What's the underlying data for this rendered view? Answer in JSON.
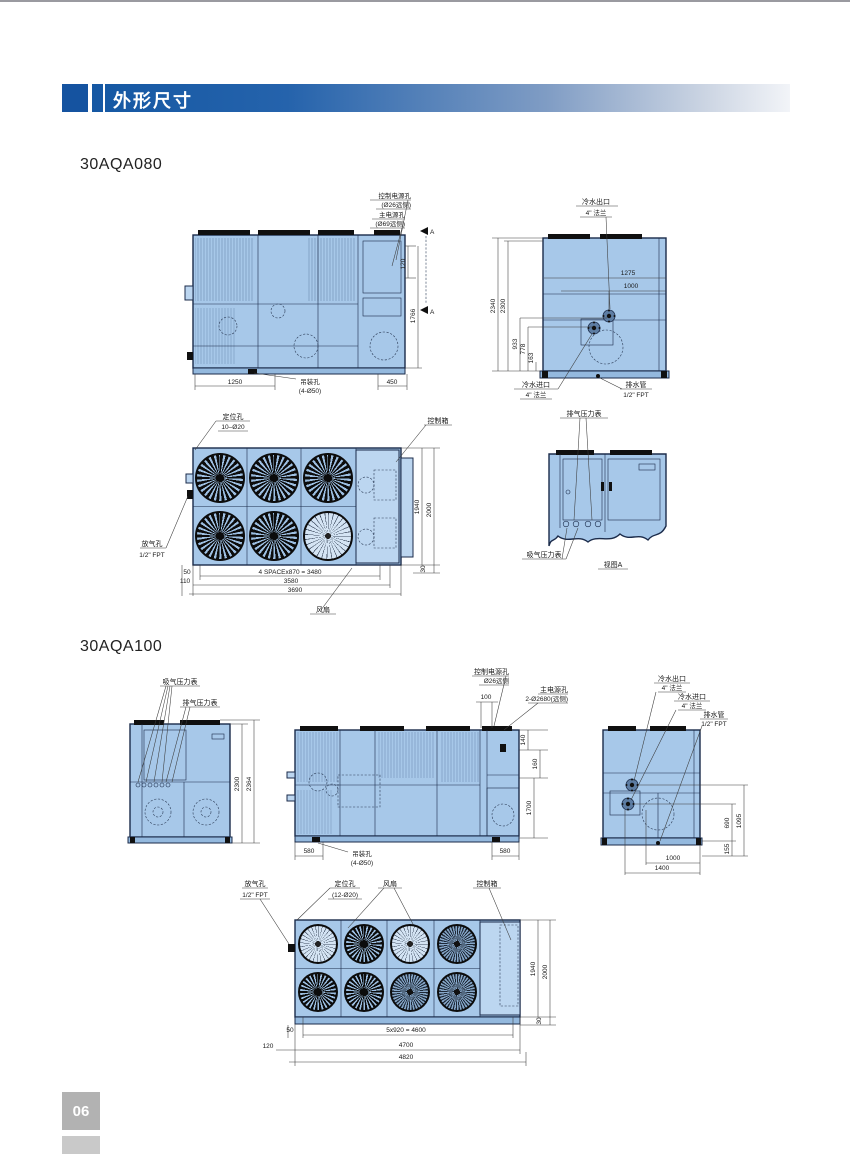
{
  "page": {
    "header_title": "外形尺寸",
    "page_number": "06",
    "model_080": "30AQA080",
    "model_100": "30AQA100"
  },
  "aqa080": {
    "front": {
      "control_power": "控制电源孔",
      "control_power_d": "(Ø26远侧)",
      "main_power": "主电源孔",
      "main_power_d": "(Ø69远侧)",
      "section_a_top": "A",
      "section_a_bottom": "A",
      "d120": "120",
      "d1766": "1766",
      "d1250": "1250",
      "lifting": "吊装孔",
      "lifting_d": "(4-Ø50)",
      "d450": "450"
    },
    "side": {
      "outlet": "冷水出口",
      "outlet_d": "4\" 法兰",
      "d1275": "1275",
      "d1000": "1000",
      "d2340": "2340",
      "d2300": "2300",
      "d933": "933",
      "d778": "778",
      "d163": "163",
      "inlet": "冷水进口",
      "inlet_d": "4\" 法兰",
      "drain": "排水管",
      "drain_d": "1/2\" FPT"
    },
    "top": {
      "locating": "定位孔",
      "locating_d": "10–Ø20",
      "control_box": "控制箱",
      "vent": "放气孔",
      "vent_d": "1/2\" FPT",
      "d50": "50",
      "d110": "110",
      "space": "4 SPACEx870 = 3480",
      "d3580": "3580",
      "d3690": "3690",
      "d1940": "1940",
      "d2000": "2000",
      "d30": "30",
      "fan": "风扇"
    },
    "detail": {
      "discharge": "排气压力表",
      "suction": "吸气压力表",
      "view_a": "视图A"
    }
  },
  "aqa100": {
    "left": {
      "suction": "吸气压力表",
      "discharge": "排气压力表",
      "d2300": "2300",
      "d2364": "2364"
    },
    "front": {
      "control_power": "控制电源孔",
      "control_power_d": "Ø26远侧",
      "d100": "100",
      "main_power": "主电源孔",
      "main_power_d": "2-Ø2680(远侧)",
      "d140": "140",
      "d160": "160",
      "d1700": "1700",
      "d580_left": "580",
      "lifting": "吊装孔",
      "lifting_d": "(4-Ø50)",
      "d580_right": "580"
    },
    "right": {
      "outlet": "冷水出口",
      "outlet_d": "4\" 法兰",
      "inlet": "冷水进口",
      "inlet_d": "4\" 法兰",
      "drain": "排水管",
      "drain_d": "1/2\" FPT",
      "d1095": "1095",
      "d690": "690",
      "d155": "155",
      "d1000": "1000",
      "d1400": "1400"
    },
    "top": {
      "vent": "放气孔",
      "vent_d": "1/2\" FPT",
      "locating": "定位孔",
      "locating_d": "(12-Ø20)",
      "fan": "风扇",
      "control_box": "控制箱",
      "d1940": "1940",
      "d2000": "2000",
      "d30": "30",
      "d50": "50",
      "d120": "120",
      "space": "5x920 = 4600",
      "d4700": "4700",
      "d4820": "4820"
    }
  }
}
